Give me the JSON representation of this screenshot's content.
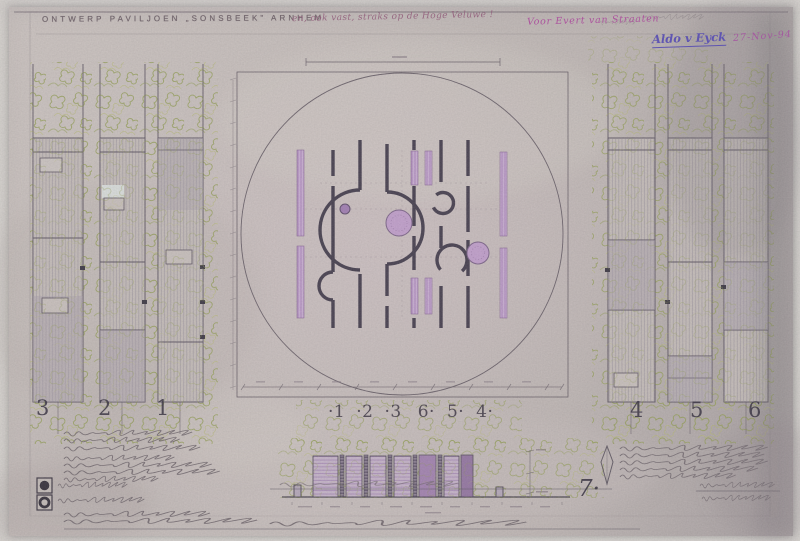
{
  "titleblock": {
    "title": "ONTWERP PAVILJOEN  „SONSBEEK”  ARNHEM",
    "subtitle_note": "en, ook vast, straks op de Hoge Veluwe !",
    "dedication": "Voor Evert van Straaten",
    "signature": "Aldo v Eyck",
    "date": "27-Nov-94"
  },
  "plan": {
    "wall_numbers": [
      "·1",
      "·2",
      "·3",
      "6·",
      "5·",
      "4·"
    ],
    "section_number": "7·"
  },
  "elevations": {
    "left": [
      "3",
      "2",
      "1"
    ],
    "right": [
      "4",
      "5",
      "6"
    ]
  },
  "colors": {
    "paper": "#c7beba",
    "wall_ink": "#463f4e",
    "plan_purple": "#b48cc0",
    "ink_magenta": "#ab4e9c",
    "ink_blue": "#5b51b2",
    "foliage_green": "#99a25e"
  }
}
